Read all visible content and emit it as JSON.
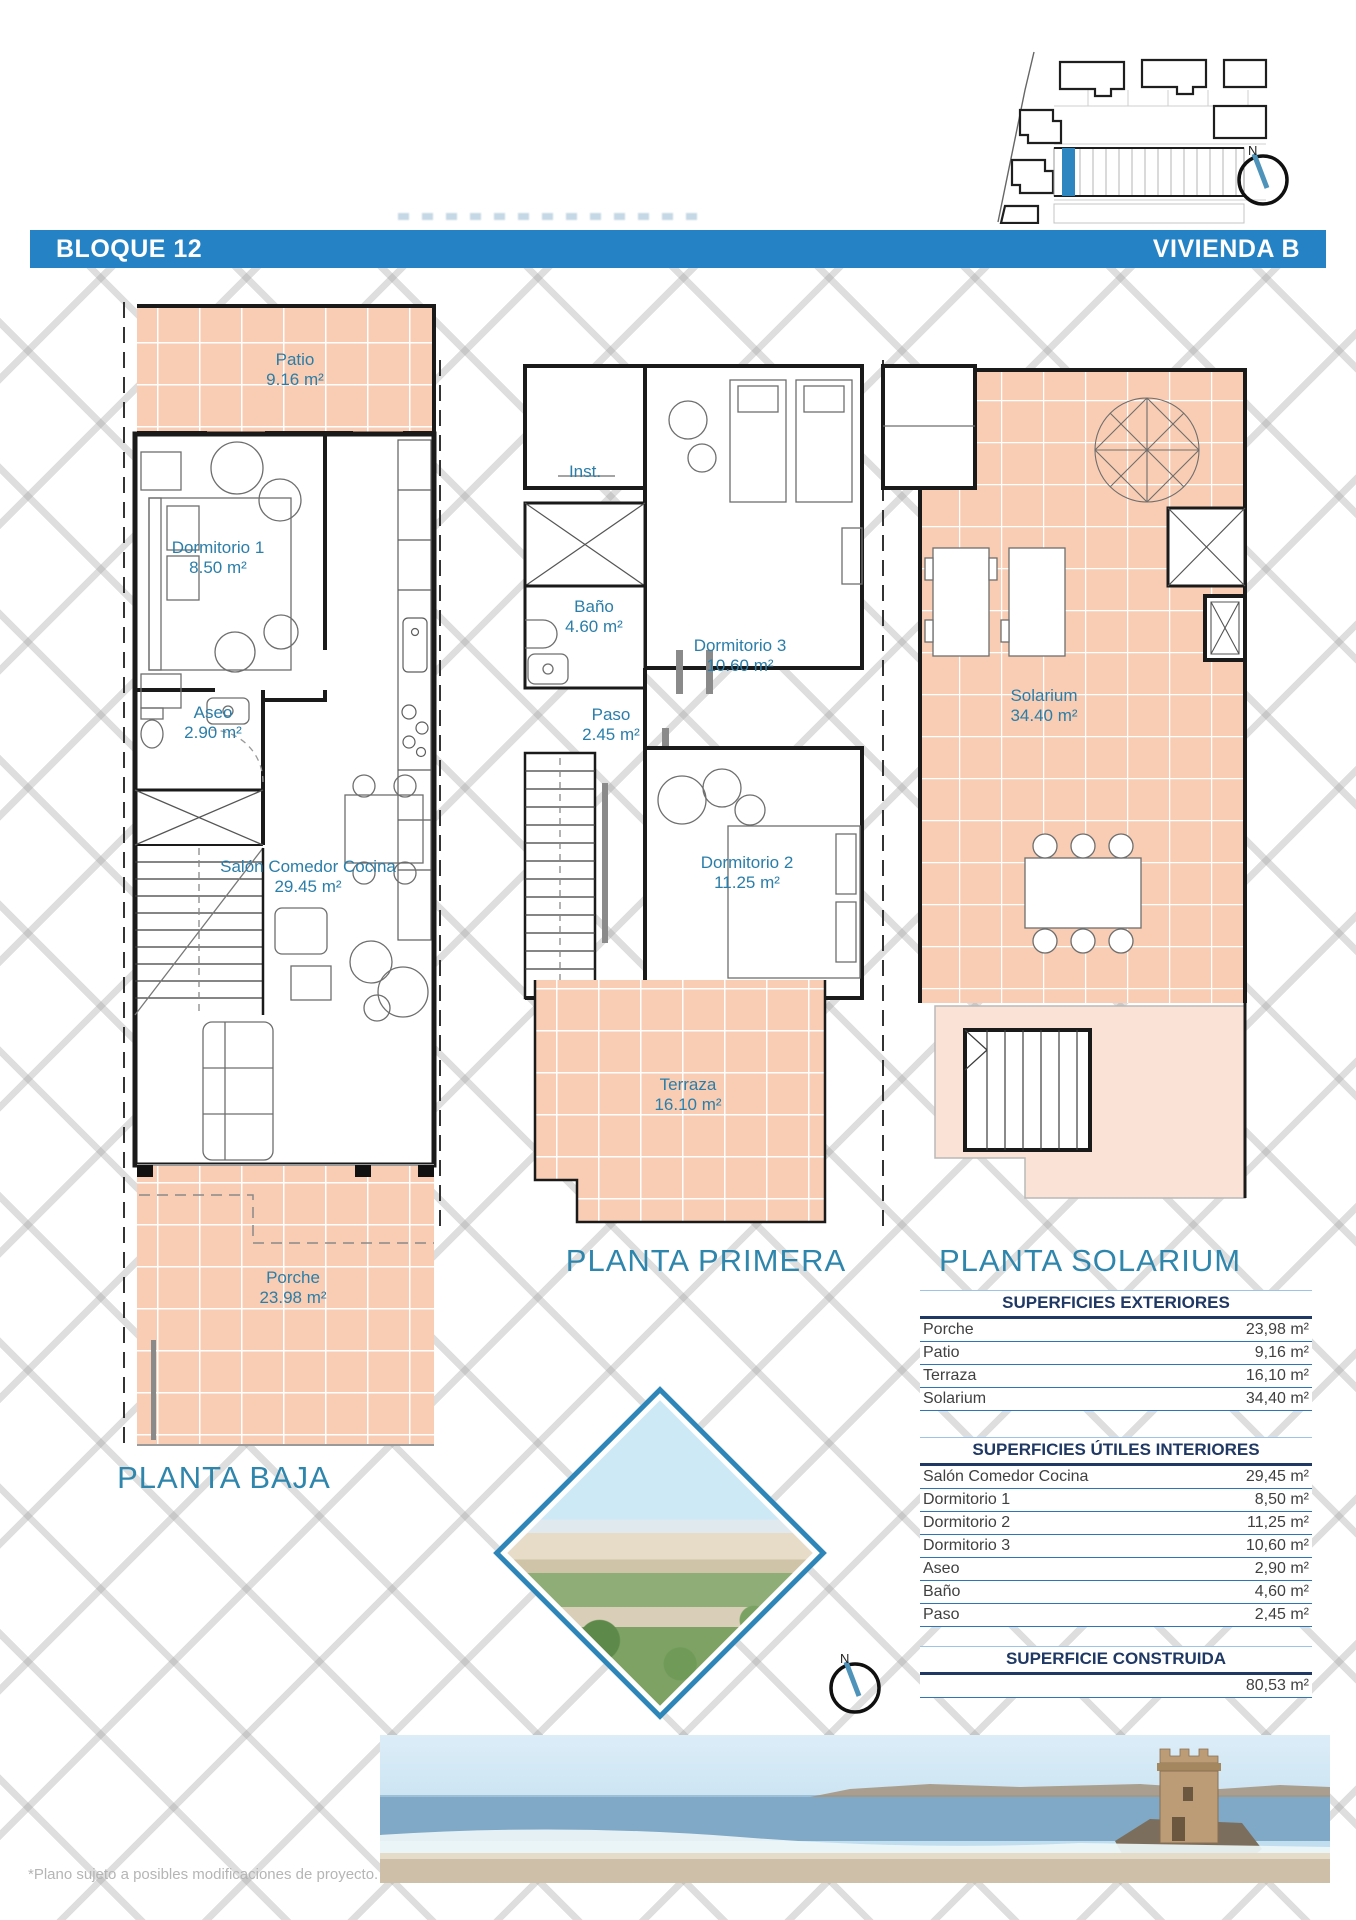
{
  "header": {
    "left_label": "BLOQUE 12",
    "right_label": "VIVIENDA B"
  },
  "compass": {
    "label": "N"
  },
  "floors": {
    "ground": {
      "title": "PLANTA BAJA",
      "rooms": {
        "patio": {
          "name": "Patio",
          "area": "9.16 m²"
        },
        "dormitorio1": {
          "name": "Dormitorio 1",
          "area": "8.50 m²"
        },
        "aseo": {
          "name": "Aseo",
          "area": "2.90 m²"
        },
        "salon": {
          "name": "Salón Comedor Cocina",
          "area": "29.45 m²"
        },
        "porche": {
          "name": "Porche",
          "area": "23.98 m²"
        }
      }
    },
    "first": {
      "title": "PLANTA PRIMERA",
      "rooms": {
        "inst": {
          "name": "Inst."
        },
        "bano": {
          "name": "Baño",
          "area": "4.60 m²"
        },
        "dormitorio3": {
          "name": "Dormitorio 3",
          "area": "10.60 m²"
        },
        "paso": {
          "name": "Paso",
          "area": "2.45 m²"
        },
        "dormitorio2": {
          "name": "Dormitorio 2",
          "area": "11.25 m²"
        },
        "terraza": {
          "name": "Terraza",
          "area": "16.10 m²"
        }
      }
    },
    "solarium": {
      "title": "PLANTA SOLARIUM",
      "rooms": {
        "solarium": {
          "name": "Solarium",
          "area": "34.40 m²"
        }
      }
    }
  },
  "tables": {
    "exteriores": {
      "title": "SUPERFICIES EXTERIORES",
      "rows": [
        {
          "label": "Porche",
          "value": "23,98 m²"
        },
        {
          "label": "Patio",
          "value": "9,16 m²"
        },
        {
          "label": "Terraza",
          "value": "16,10 m²"
        },
        {
          "label": "Solarium",
          "value": "34,40 m²"
        }
      ]
    },
    "interiores": {
      "title": "SUPERFICIES ÚTILES INTERIORES",
      "rows": [
        {
          "label": "Salón Comedor Cocina",
          "value": "29,45 m²"
        },
        {
          "label": "Dormitorio 1",
          "value": "8,50 m²"
        },
        {
          "label": "Dormitorio 2",
          "value": "11,25 m²"
        },
        {
          "label": "Dormitorio 3",
          "value": "10,60 m²"
        },
        {
          "label": "Aseo",
          "value": "2,90 m²"
        },
        {
          "label": "Baño",
          "value": "4,60 m²"
        },
        {
          "label": "Paso",
          "value": "2,45 m²"
        }
      ]
    },
    "construida": {
      "title": "SUPERFICIE CONSTRUIDA",
      "value": "80,53 m²"
    }
  },
  "footer": {
    "note": "*Plano sujeto a posibles modificaciones de proyecto."
  },
  "colors": {
    "accent_blue": "#2583c5",
    "plan_label_blue": "#2a7ea9",
    "salmon": "#f8cdb3",
    "salmon_light": "#fbe2d6",
    "table_navy": "#1f3864",
    "table_line_blue": "#2e75b6"
  }
}
